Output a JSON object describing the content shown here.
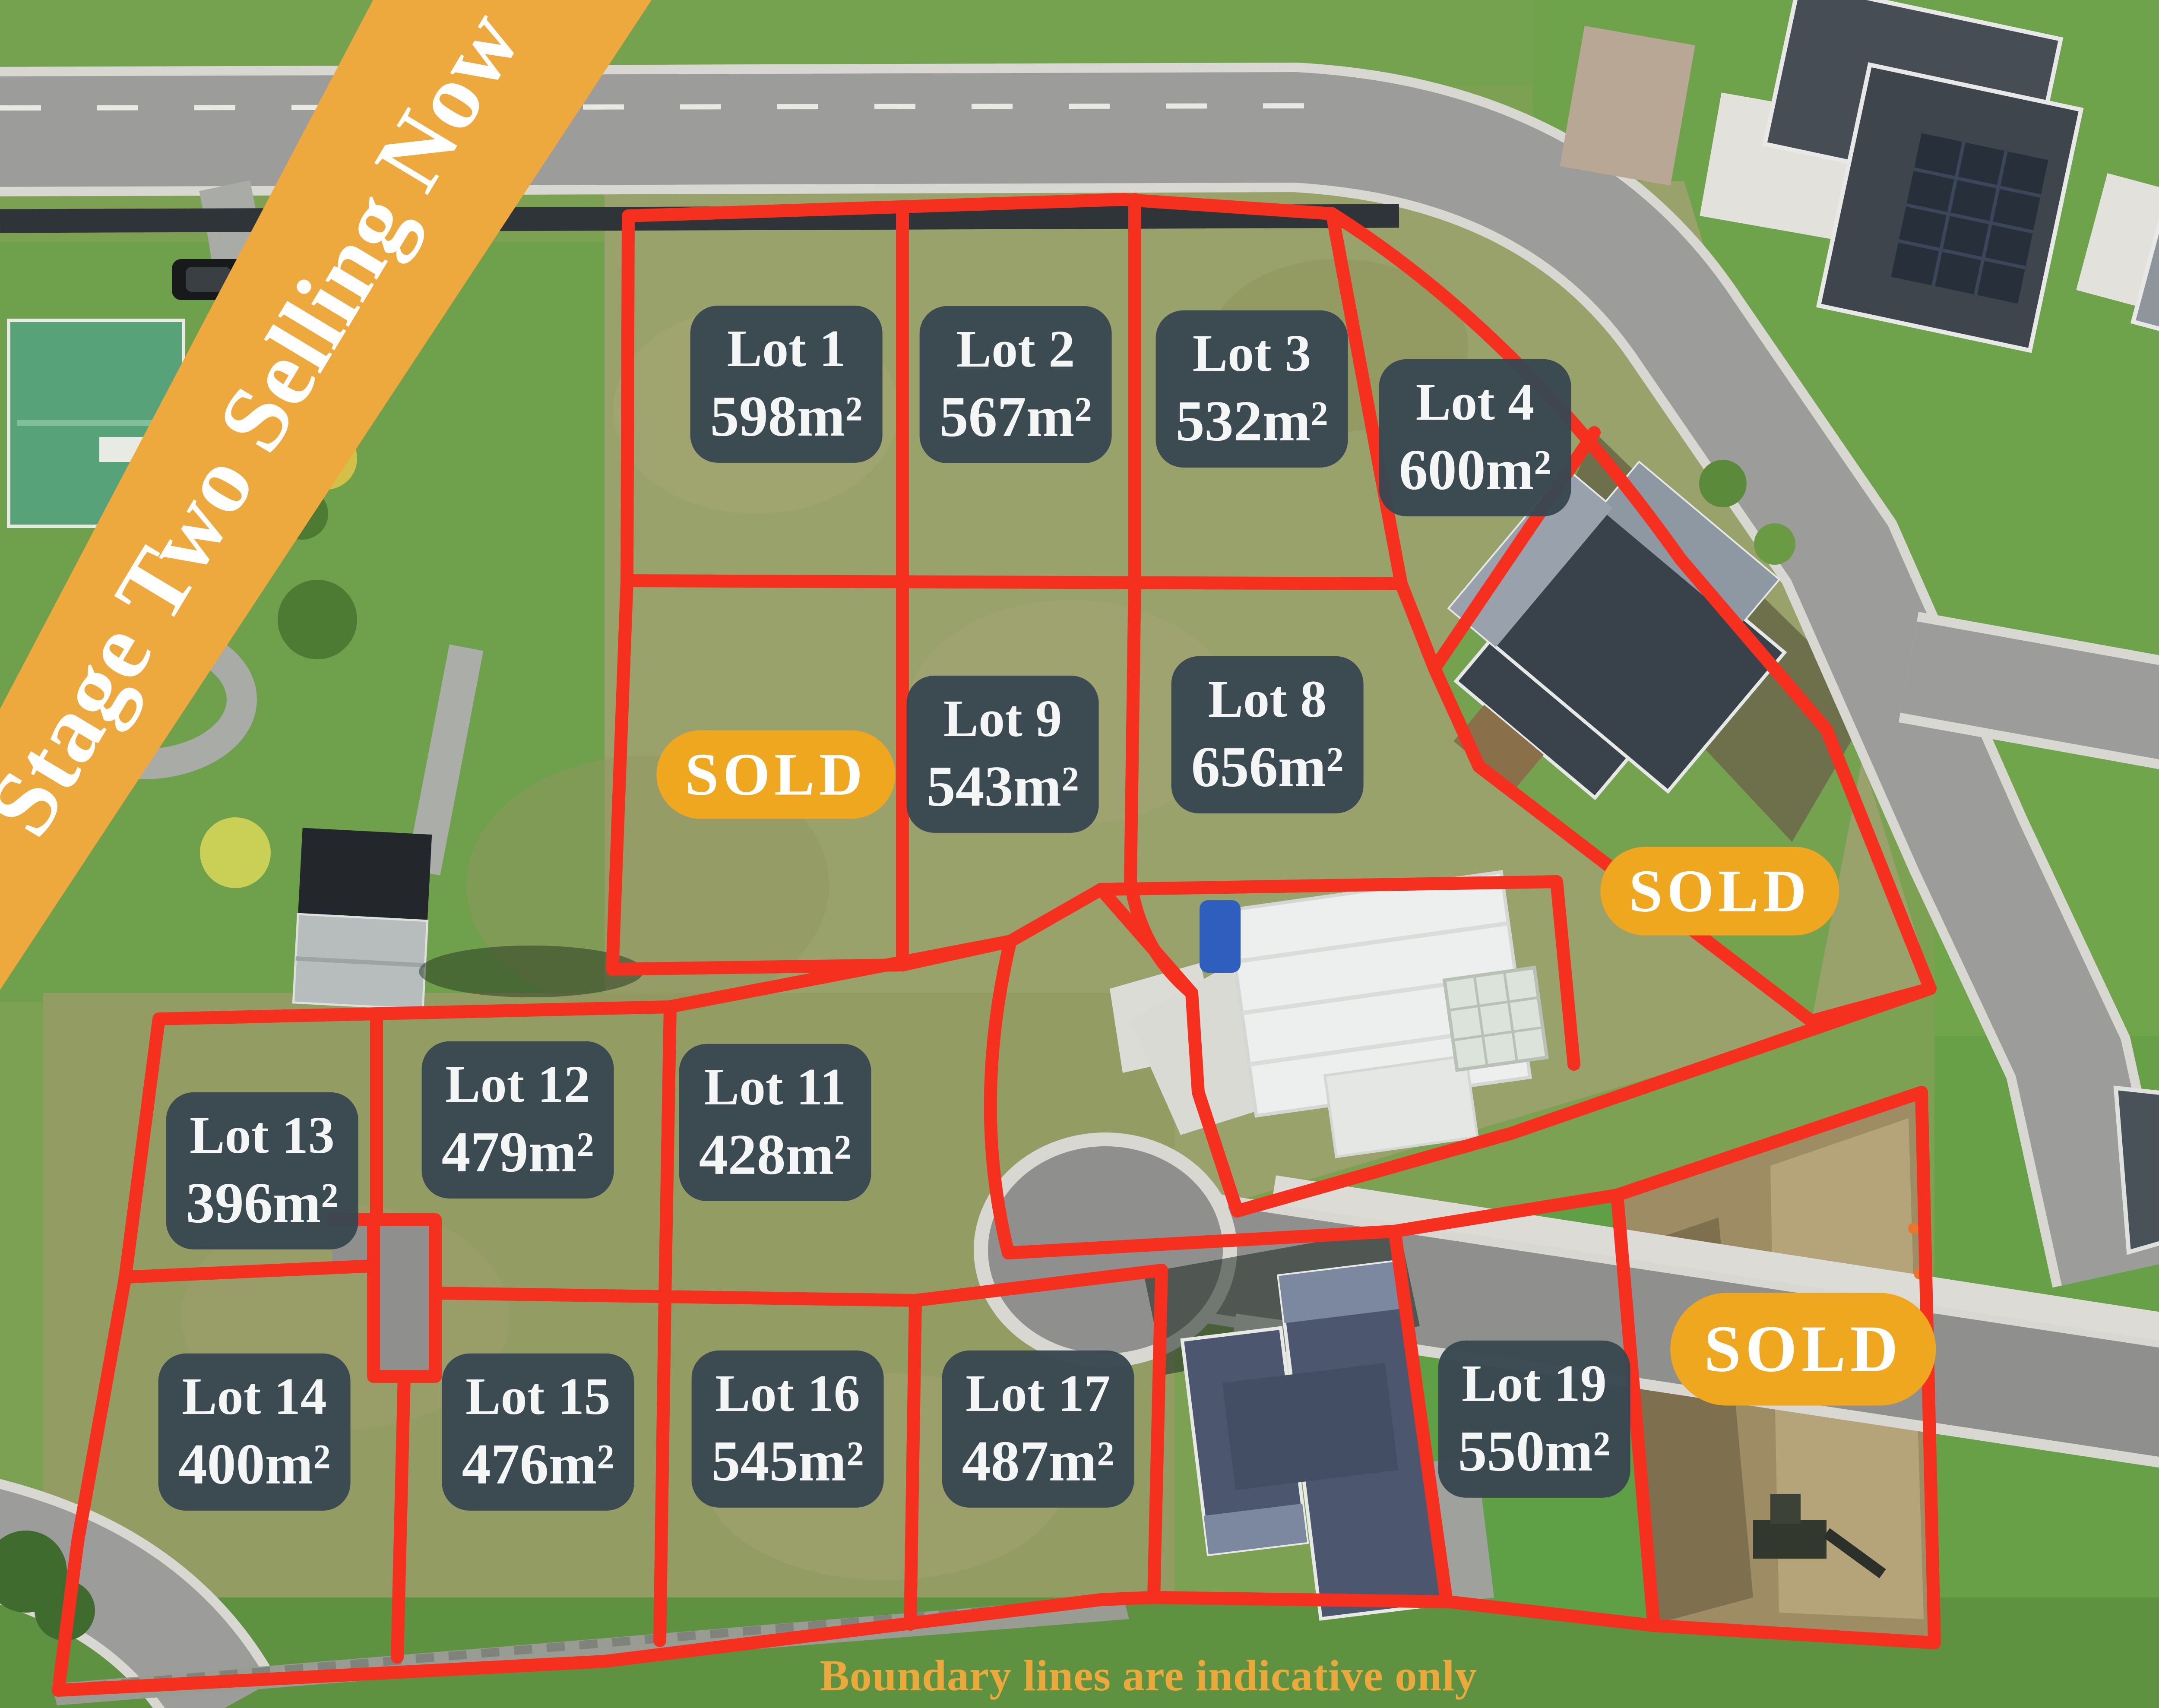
{
  "banner": {
    "label": "Stage Two Selling Now",
    "bg_color": "#EEA93E",
    "text_color": "#FFFFFF"
  },
  "footer": {
    "note": "Boundary lines are indicative only",
    "color": "#EBA93C"
  },
  "map": {
    "boundary_color": "#F5301E",
    "label_bg_color": "#394751",
    "label_text_color": "#F4F6F6",
    "sold_badge_bg_color": "#EFA71F",
    "sold_badge_text_color": "#FFFFFF"
  },
  "lots": [
    {
      "id": "lot-1",
      "name": "Lot 1",
      "area": "598m²",
      "status": "available"
    },
    {
      "id": "lot-2",
      "name": "Lot 2",
      "area": "567m²",
      "status": "available"
    },
    {
      "id": "lot-3",
      "name": "Lot 3",
      "area": "532m²",
      "status": "available"
    },
    {
      "id": "lot-4",
      "name": "Lot 4",
      "area": "600m²",
      "status": "available"
    },
    {
      "id": "lot-8",
      "name": "Lot 8",
      "area": "656m²",
      "status": "available"
    },
    {
      "id": "lot-9",
      "name": "Lot 9",
      "area": "543m²",
      "status": "available"
    },
    {
      "id": "lot-11",
      "name": "Lot 11",
      "area": "428m²",
      "status": "available"
    },
    {
      "id": "lot-12",
      "name": "Lot 12",
      "area": "479m²",
      "status": "available"
    },
    {
      "id": "lot-13",
      "name": "Lot 13",
      "area": "396m²",
      "status": "available"
    },
    {
      "id": "lot-14",
      "name": "Lot 14",
      "area": "400m²",
      "status": "available"
    },
    {
      "id": "lot-15",
      "name": "Lot 15",
      "area": "476m²",
      "status": "available"
    },
    {
      "id": "lot-16",
      "name": "Lot 16",
      "area": "545m²",
      "status": "available"
    },
    {
      "id": "lot-17",
      "name": "Lot 17",
      "area": "487m²",
      "status": "available"
    },
    {
      "id": "lot-19",
      "name": "Lot 19",
      "area": "550m²",
      "status": "available"
    }
  ],
  "sold_badges": [
    {
      "id": "sold-west",
      "label": "SOLD"
    },
    {
      "id": "sold-east",
      "label": "SOLD"
    },
    {
      "id": "sold-south",
      "label": "SOLD"
    }
  ]
}
